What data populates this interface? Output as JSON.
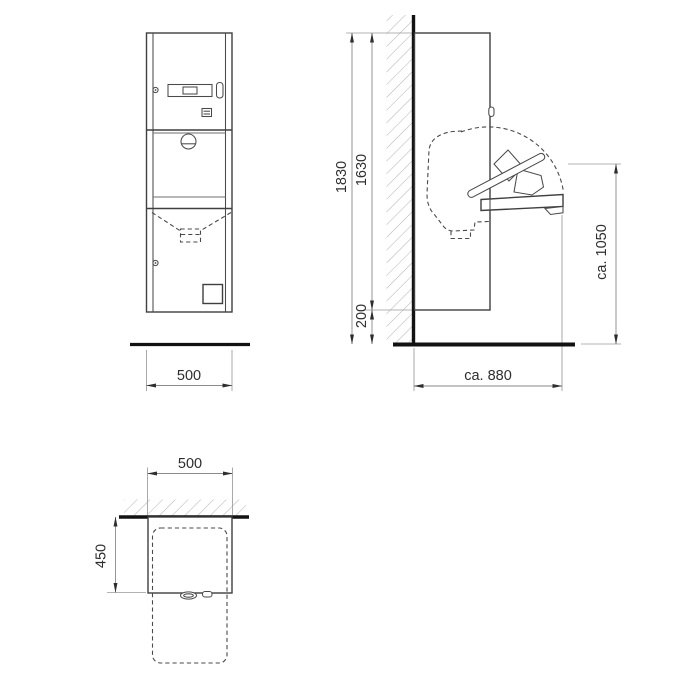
{
  "views": {
    "front": {
      "width_dim": "500"
    },
    "side": {
      "total_height_dim": "1830",
      "cabinet_height_dim": "1630",
      "floor_gap_dim": "200",
      "table_height_dim": "ca. 1050",
      "open_depth_dim": "ca. 880"
    },
    "top": {
      "width_dim": "500",
      "depth_dim": "450"
    }
  },
  "colors": {
    "outline": "#3f3f3f",
    "dashed_line": "#4a4a4a",
    "dimension_line": "#8a8a8a",
    "extension_line": "#9a9a9a",
    "hatching": "#a8a8a8",
    "text_and_arrows": "#2e2e2e",
    "wall_and_floor": "#121212",
    "background": "#ffffff"
  }
}
